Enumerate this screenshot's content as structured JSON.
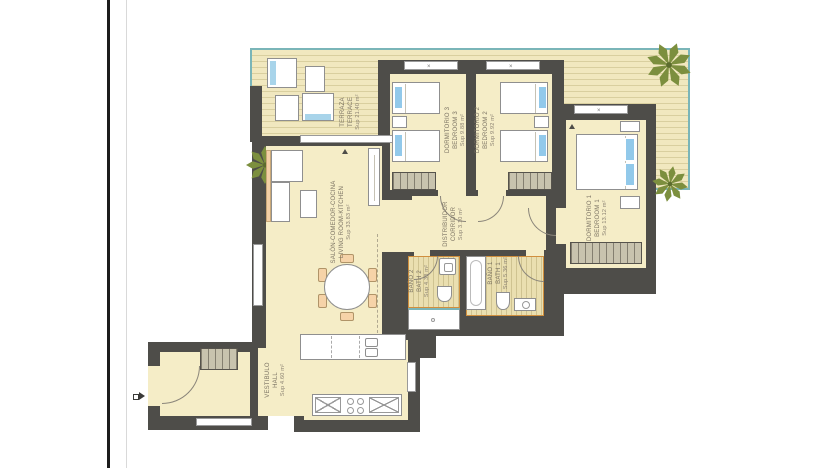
{
  "page": {
    "background": "#ffffff"
  },
  "colors": {
    "wall": "#4e4d49",
    "floor_cream": "#f5edc7",
    "terrace_edge_teal": "#7ab5b8",
    "bath_trim_orange": "#d08f3e",
    "pillow_blue": "#92c9ea",
    "palm_green": "#7c8f3e",
    "label_text": "#7b7363"
  },
  "rooms": {
    "terrace": {
      "name_es": "TERRAZA",
      "name_en": "TERRACE",
      "area": "Sup 21.40 m²"
    },
    "living": {
      "name_es": "SALÓN-COMEDOR-COCINA",
      "name_en": "LIVING ROOM-KITCHEN",
      "area": "Sup 33.83 m²"
    },
    "bedroom3": {
      "name_es": "DORMITORIO 3",
      "name_en": "BEDROOM 3",
      "area": "Sup 9.88 m²"
    },
    "bedroom2": {
      "name_es": "DORMITORIO 2",
      "name_en": "BEDROOM 2",
      "area": "Sup 9.92 m²"
    },
    "bedroom1": {
      "name_es": "DORMITORIO 1",
      "name_en": "BEDROOM 1",
      "area": "Sup 13.12 m²"
    },
    "corridor": {
      "name_es": "DISTRIBUIDOR",
      "name_en": "CORRIDOR",
      "area": "Sup 3.10 m²"
    },
    "bath2": {
      "name_es": "BAÑO 2",
      "name_en": "BATH 2",
      "area": "Sup 4.38 m²"
    },
    "bath1": {
      "name_es": "BAÑO 1",
      "name_en": "BATH 1",
      "area": "Sup 5.36 m²"
    },
    "hall": {
      "name_es": "VESTIBULO",
      "name_en": "HALL",
      "area": "Sup 4.60 m²"
    }
  },
  "window_marks": {
    "mark": "×"
  }
}
